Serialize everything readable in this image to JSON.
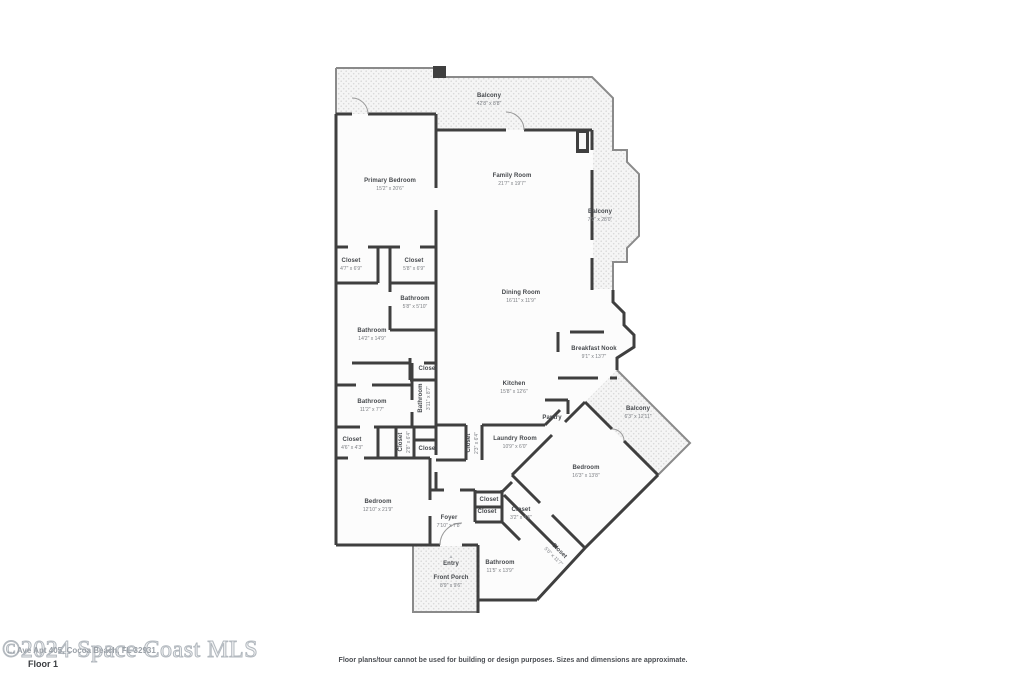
{
  "footer": {
    "floor_label": "Floor 1",
    "disclaimer": "Floor plans/tour cannot be used for building or design purposes. Sizes and dimensions are approximate.",
    "watermark_large": "©2024 Space Coast MLS",
    "watermark_small": "… Ave Apt 405, Cocoa Beach, FL 32931"
  },
  "icons": {
    "entry_arrow": "▲"
  },
  "colors": {
    "wall": "#3f3f3f",
    "railing": "#8a8a8a",
    "room_fill": "#fcfcfc",
    "balcony_dot": "#d9d9d9",
    "label_text": "#45484c",
    "dims_text": "#7b7e83"
  },
  "rooms": {
    "balcony_top": {
      "name": "Balcony",
      "dims": "42'8\" x 8'8\""
    },
    "primary_bedroom": {
      "name": "Primary Bedroom",
      "dims": "15'2\" x 20'6\""
    },
    "family_room": {
      "name": "Family Room",
      "dims": "21'7\" x 19'7\""
    },
    "balcony_right": {
      "name": "Balcony",
      "dims": "7'9\" x 28'0\""
    },
    "closet_primary_1": {
      "name": "Closet",
      "dims": "4'7\" x 6'9\""
    },
    "closet_primary_2": {
      "name": "Closet",
      "dims": "5'8\" x 6'9\""
    },
    "bathroom_ensuite": {
      "name": "Bathroom",
      "dims": "5'8\" x 5'10\""
    },
    "bathroom_primary": {
      "name": "Bathroom",
      "dims": "14'2\" x 14'9\""
    },
    "dining_room": {
      "name": "Dining Room",
      "dims": "16'11\" x 11'9\""
    },
    "breakfast_nook": {
      "name": "Breakfast Nook",
      "dims": "9'1\" x 13'7\""
    },
    "kitchen": {
      "name": "Kitchen",
      "dims": "15'8\" x 12'6\""
    },
    "bathroom_hall": {
      "name": "Bathroom",
      "dims": "11'2\" x 7'7\""
    },
    "bathroom_side": {
      "name": "Bathroom",
      "dims": "3'11\" x 8'7\""
    },
    "closet_hall_top": {
      "name": "Closet",
      "dims": ""
    },
    "pantry": {
      "name": "Pantry",
      "dims": ""
    },
    "laundry_room": {
      "name": "Laundry Room",
      "dims": "10'9\" x 6'0\""
    },
    "closet_laundry": {
      "name": "Closet",
      "dims": "2'3\" x 6'4\""
    },
    "closet_hall_left": {
      "name": "Closet",
      "dims": "4'6\" x 4'3\""
    },
    "closet_hall_mid": {
      "name": "Closet",
      "dims": "2'8\" x 6'4\""
    },
    "closet_hall_small": {
      "name": "Closet",
      "dims": ""
    },
    "balcony_diamond": {
      "name": "Balcony",
      "dims": "6'3\" x 12'11\""
    },
    "bedroom_right": {
      "name": "Bedroom",
      "dims": "16'3\" x 13'8\""
    },
    "bedroom_left": {
      "name": "Bedroom",
      "dims": "12'10\" x 21'9\""
    },
    "foyer": {
      "name": "Foyer",
      "dims": "7'10\" x 7'8\""
    },
    "closet_foyer_1": {
      "name": "Closet",
      "dims": ""
    },
    "closet_foyer_2": {
      "name": "Closet",
      "dims": ""
    },
    "closet_foyer_3": {
      "name": "Closet",
      "dims": "3'2\" x 4'5\""
    },
    "entry": {
      "name": "Entry",
      "dims": ""
    },
    "front_porch": {
      "name": "Front Porch",
      "dims": "8'9\" x 9'6\""
    },
    "bathroom_guest": {
      "name": "Bathroom",
      "dims": "11'5\" x 13'9\""
    },
    "closet_diag": {
      "name": "Closet",
      "dims": "5'0\" x 11'7\""
    }
  }
}
